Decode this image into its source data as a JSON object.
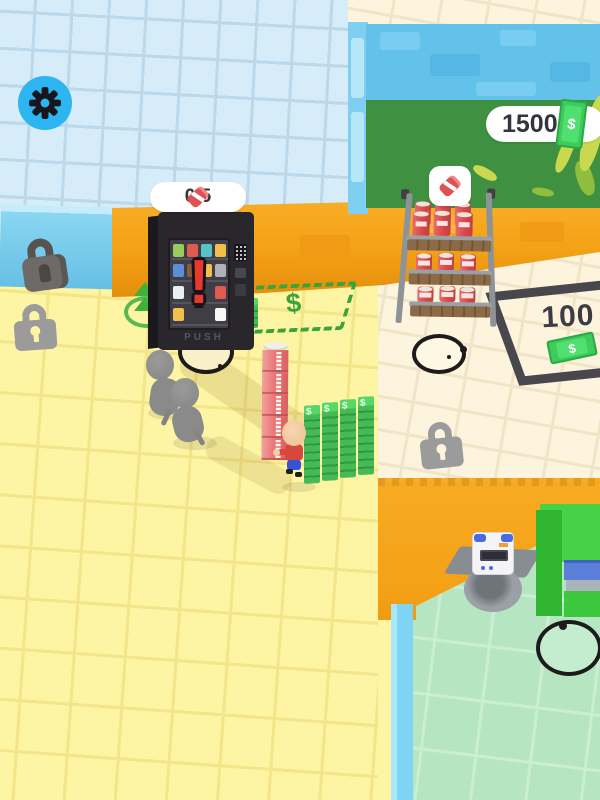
{
  "game": {
    "hud": {
      "settings": {
        "icon": "gear-icon"
      },
      "money_counter": {
        "value": "1500",
        "currency_icon": "money-bill-icon"
      },
      "vending_stock_counter": {
        "value": "0/5",
        "item_icon": "soda-can-icon"
      }
    },
    "symbols": {
      "dollar": "$"
    },
    "vending_machine": {
      "alert": "!",
      "push_label": "PUSH"
    },
    "shelf_restock": {
      "icon": "soda-can-icon"
    },
    "zones": {
      "sell_zone": {
        "symbol": "$"
      },
      "locked_area": {
        "price": "100"
      }
    },
    "colors": {
      "accent_blue": "#2cb5f0",
      "money_green": "#3ecb5a",
      "alert_red": "#e8392f",
      "zone_green": "#3aa33a",
      "wall_orange": "#f4a116"
    }
  }
}
